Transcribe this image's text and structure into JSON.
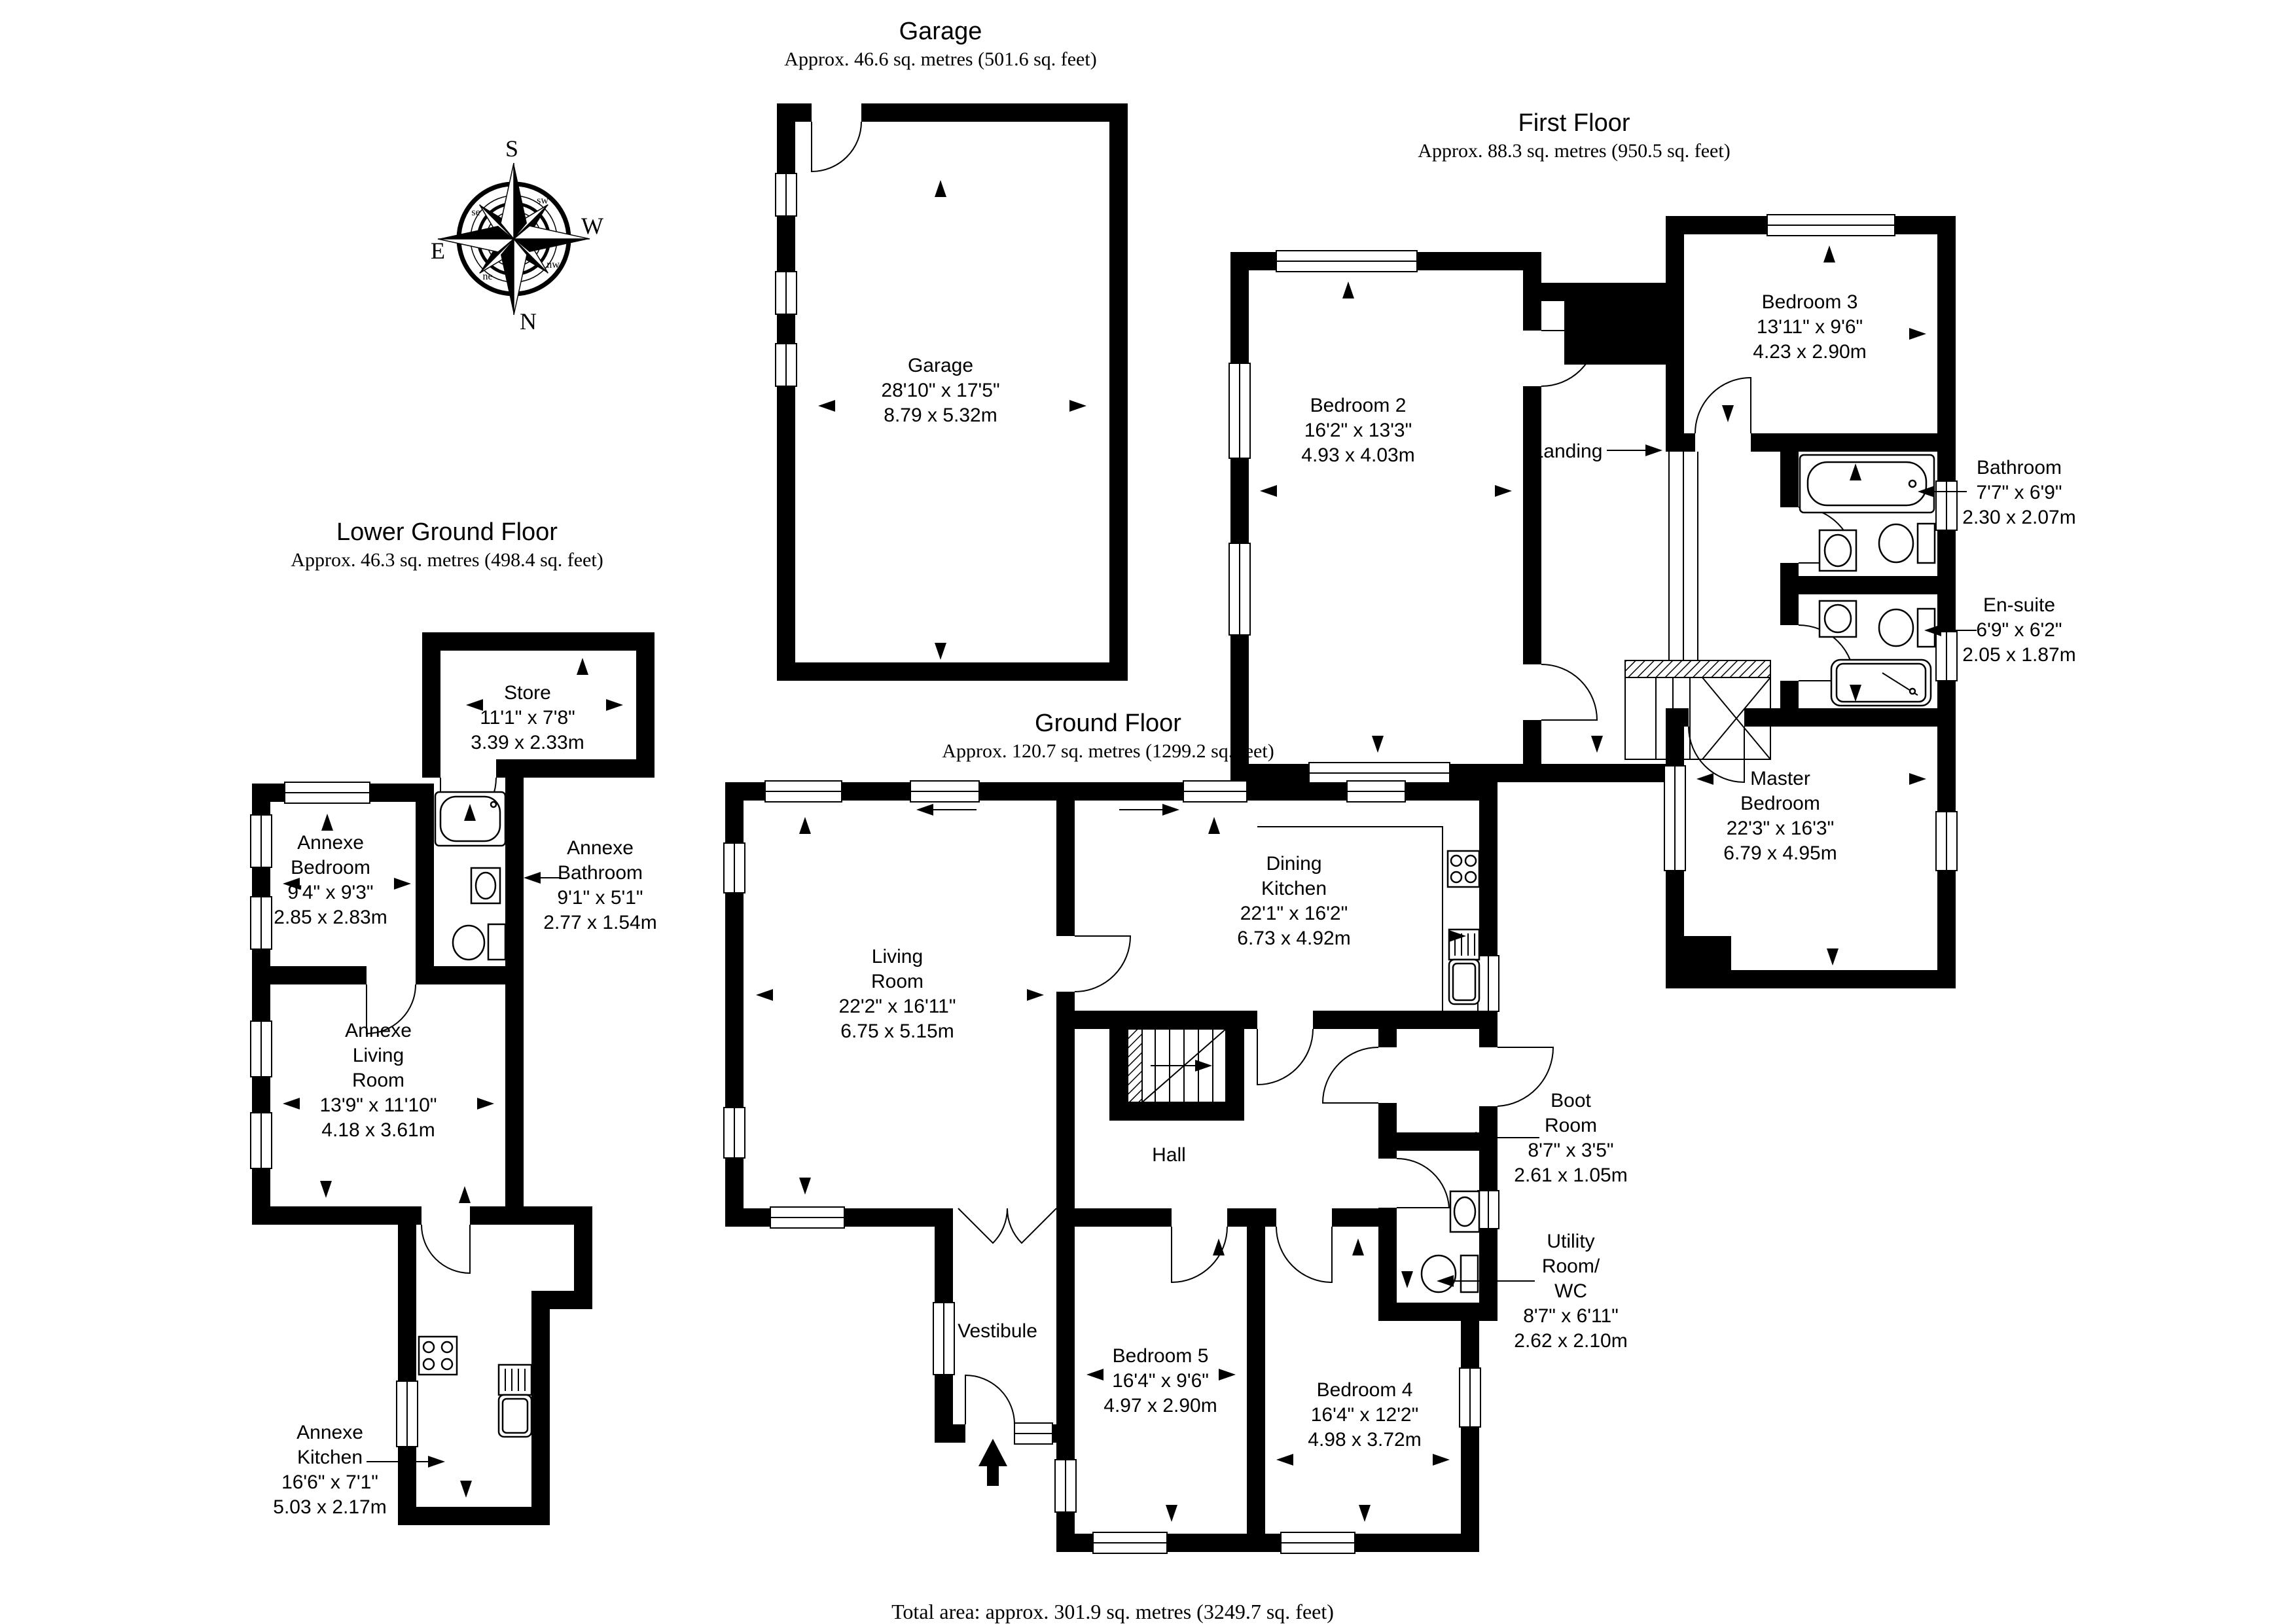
{
  "colors": {
    "ink": "#000000",
    "background": "#ffffff"
  },
  "floors": {
    "garage": {
      "title": "Garage",
      "area": "Approx. 46.6 sq. metres (501.6 sq. feet)"
    },
    "first_floor": {
      "title": "First Floor",
      "area": "Approx. 88.3 sq. metres (950.5 sq. feet)"
    },
    "lower_ground_floor": {
      "title": "Lower Ground Floor",
      "area": "Approx. 46.3 sq. metres (498.4 sq. feet)"
    },
    "ground_floor": {
      "title": "Ground Floor",
      "area": "Approx. 120.7 sq. metres (1299.2 sq. feet)"
    }
  },
  "rooms": {
    "garage": {
      "name": "Garage",
      "imperial": "28'10\" x 17'5\"",
      "metric": "8.79 x 5.32m"
    },
    "bedroom2": {
      "name": "Bedroom 2",
      "imperial": "16'2\" x 13'3\"",
      "metric": "4.93 x 4.03m"
    },
    "bedroom3": {
      "name": "Bedroom 3",
      "imperial": "13'11\" x 9'6\"",
      "metric": "4.23 x 2.90m"
    },
    "landing": {
      "name": "Landing"
    },
    "bathroom": {
      "name": "Bathroom",
      "imperial": "7'7\" x 6'9\"",
      "metric": "2.30 x 2.07m"
    },
    "ensuite": {
      "name": "En-suite",
      "imperial": "6'9\" x 6'2\"",
      "metric": "2.05 x 1.87m"
    },
    "master": {
      "name": "Master Bedroom",
      "imperial": "22'3\" x 16'3\"",
      "metric": "6.79 x 4.95m"
    },
    "store": {
      "name": "Store",
      "imperial": "11'1\" x 7'8\"",
      "metric": "3.39 x 2.33m"
    },
    "annexe_bedroom": {
      "name": "Annexe Bedroom",
      "imperial": "9'4\" x 9'3\"",
      "metric": "2.85 x 2.83m"
    },
    "annexe_bathroom": {
      "name": "Annexe Bathroom",
      "imperial": "9'1\" x 5'1\"",
      "metric": "2.77 x 1.54m"
    },
    "annexe_living": {
      "name": "Annexe Living Room",
      "imperial": "13'9\" x 11'10\"",
      "metric": "4.18 x 3.61m"
    },
    "annexe_kitchen": {
      "name": "Annexe Kitchen",
      "imperial": "16'6\" x 7'1\"",
      "metric": "5.03 x 2.17m"
    },
    "living": {
      "name": "Living Room",
      "imperial": "22'2\" x 16'11\"",
      "metric": "6.75 x 5.15m"
    },
    "dining_kitchen": {
      "name": "Dining Kitchen",
      "imperial": "22'1\" x 16'2\"",
      "metric": "6.73 x 4.92m"
    },
    "hall": {
      "name": "Hall"
    },
    "vestibule": {
      "name": "Vestibule"
    },
    "bedroom5": {
      "name": "Bedroom 5",
      "imperial": "16'4\" x 9'6\"",
      "metric": "4.97 x 2.90m"
    },
    "bedroom4": {
      "name": "Bedroom 4",
      "imperial": "16'4\" x 12'2\"",
      "metric": "4.98 x 3.72m"
    },
    "boot": {
      "name": "Boot Room",
      "imperial": "8'7\" x 3'5\"",
      "metric": "2.61 x 1.05m"
    },
    "utility": {
      "name": "Utility Room/ WC",
      "imperial": "8'7\" x 6'11\"",
      "metric": "2.62 x 2.10m"
    }
  },
  "compass": {
    "north": "N",
    "south": "S",
    "east": "E",
    "west": "W",
    "ne": "ne",
    "nw": "nw",
    "se": "se",
    "sw": "sw"
  },
  "footer": {
    "total_area": "Total area: approx. 301.9 sq. metres (3249.7 sq. feet)"
  }
}
